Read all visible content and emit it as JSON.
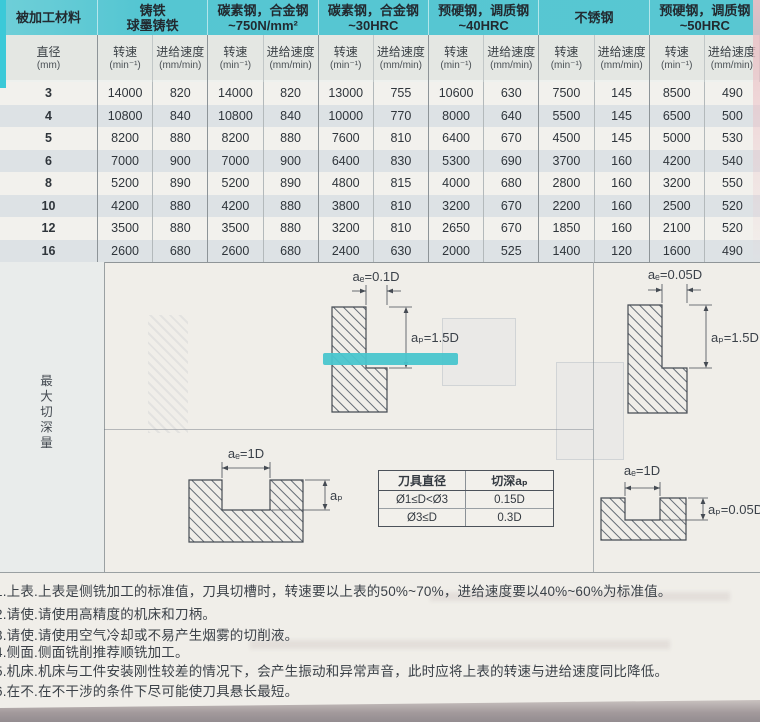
{
  "page": {
    "table": {
      "corner": "被加工材料",
      "diameter": {
        "line1": "直径",
        "line2": "(mm)"
      },
      "groups": [
        {
          "line1": "铸铁",
          "line2": "球墨铸铁"
        },
        {
          "line1": "碳素钢，合金钢",
          "line2": "~750N/mm²"
        },
        {
          "line1": "碳素钢，合金钢",
          "line2": "~30HRC"
        },
        {
          "line1": "预硬钢，调质钢",
          "line2": "~40HRC"
        },
        {
          "line1": "不锈钢",
          "line2": ""
        },
        {
          "line1": "预硬钢，调质钢",
          "line2": "~50HRC"
        }
      ],
      "speed": {
        "line1": "转速",
        "line2": "(min⁻¹)"
      },
      "feed": {
        "line1": "进给速度",
        "line2": "(mm/min)"
      },
      "rows": [
        {
          "diameter": "3",
          "values": [
            "14000",
            "820",
            "14000",
            "820",
            "13000",
            "755",
            "10600",
            "630",
            "7500",
            "145",
            "8500",
            "490"
          ]
        },
        {
          "diameter": "4",
          "values": [
            "10800",
            "840",
            "10800",
            "840",
            "10000",
            "770",
            "8000",
            "640",
            "5500",
            "145",
            "6500",
            "500"
          ]
        },
        {
          "diameter": "5",
          "values": [
            "8200",
            "880",
            "8200",
            "880",
            "7600",
            "810",
            "6400",
            "670",
            "4500",
            "145",
            "5000",
            "530"
          ]
        },
        {
          "diameter": "6",
          "values": [
            "7000",
            "900",
            "7000",
            "900",
            "6400",
            "830",
            "5300",
            "690",
            "3700",
            "160",
            "4200",
            "540"
          ]
        },
        {
          "diameter": "8",
          "values": [
            "5200",
            "890",
            "5200",
            "890",
            "4800",
            "815",
            "4000",
            "680",
            "2800",
            "160",
            "3200",
            "550"
          ]
        },
        {
          "diameter": "10",
          "values": [
            "4200",
            "880",
            "4200",
            "880",
            "3800",
            "810",
            "3200",
            "670",
            "2200",
            "160",
            "2500",
            "520"
          ]
        },
        {
          "diameter": "12",
          "values": [
            "3500",
            "880",
            "3500",
            "880",
            "3200",
            "810",
            "2650",
            "670",
            "1850",
            "160",
            "2100",
            "520"
          ]
        },
        {
          "diameter": "16",
          "values": [
            "2600",
            "680",
            "2600",
            "680",
            "2400",
            "630",
            "2000",
            "525",
            "1400",
            "120",
            "1600",
            "490"
          ]
        }
      ]
    },
    "section_label": "最大切深量",
    "diagrams": {
      "d1": {
        "ae": "aₑ=0.1D",
        "ap": "aₚ=1.5D"
      },
      "d2": {
        "ae": "aₑ=0.05D",
        "ap": "aₚ=1.5D"
      },
      "d3": {
        "ae": "aₑ=1D",
        "ap": "aₚ"
      },
      "d4": {
        "ae": "aₑ=1D",
        "ap": "aₚ=0.05D"
      }
    },
    "depth_table": {
      "col1": "刀具直径",
      "col2": "切深aₚ",
      "rows": [
        [
          "Ø1≤D<Ø3",
          "0.15D"
        ],
        [
          "Ø3≤D",
          "0.3D"
        ]
      ]
    },
    "notes": [
      "1.上表.上表是侧铣加工的标准值，刀具切槽时，转速要以上表的50%~70%，进给速度要以40%~60%为标准值。",
      "2.请使.请使用高精度的机床和刀柄。",
      "3.请使.请使用空气冷却或不易产生烟雾的切削液。",
      "4.侧面.侧面铣削推荐顺铣加工。",
      "5.机床.机床与工件安装刚性较差的情况下，会产生振动和异常声音，此时应将上表的转速与进给速度同比降低。",
      "6.在不.在不干涉的条件下尽可能使刀具悬长最短。"
    ],
    "colors": {
      "header_teal": "#58c7d2",
      "highlight_band": "#49c5cd"
    }
  }
}
